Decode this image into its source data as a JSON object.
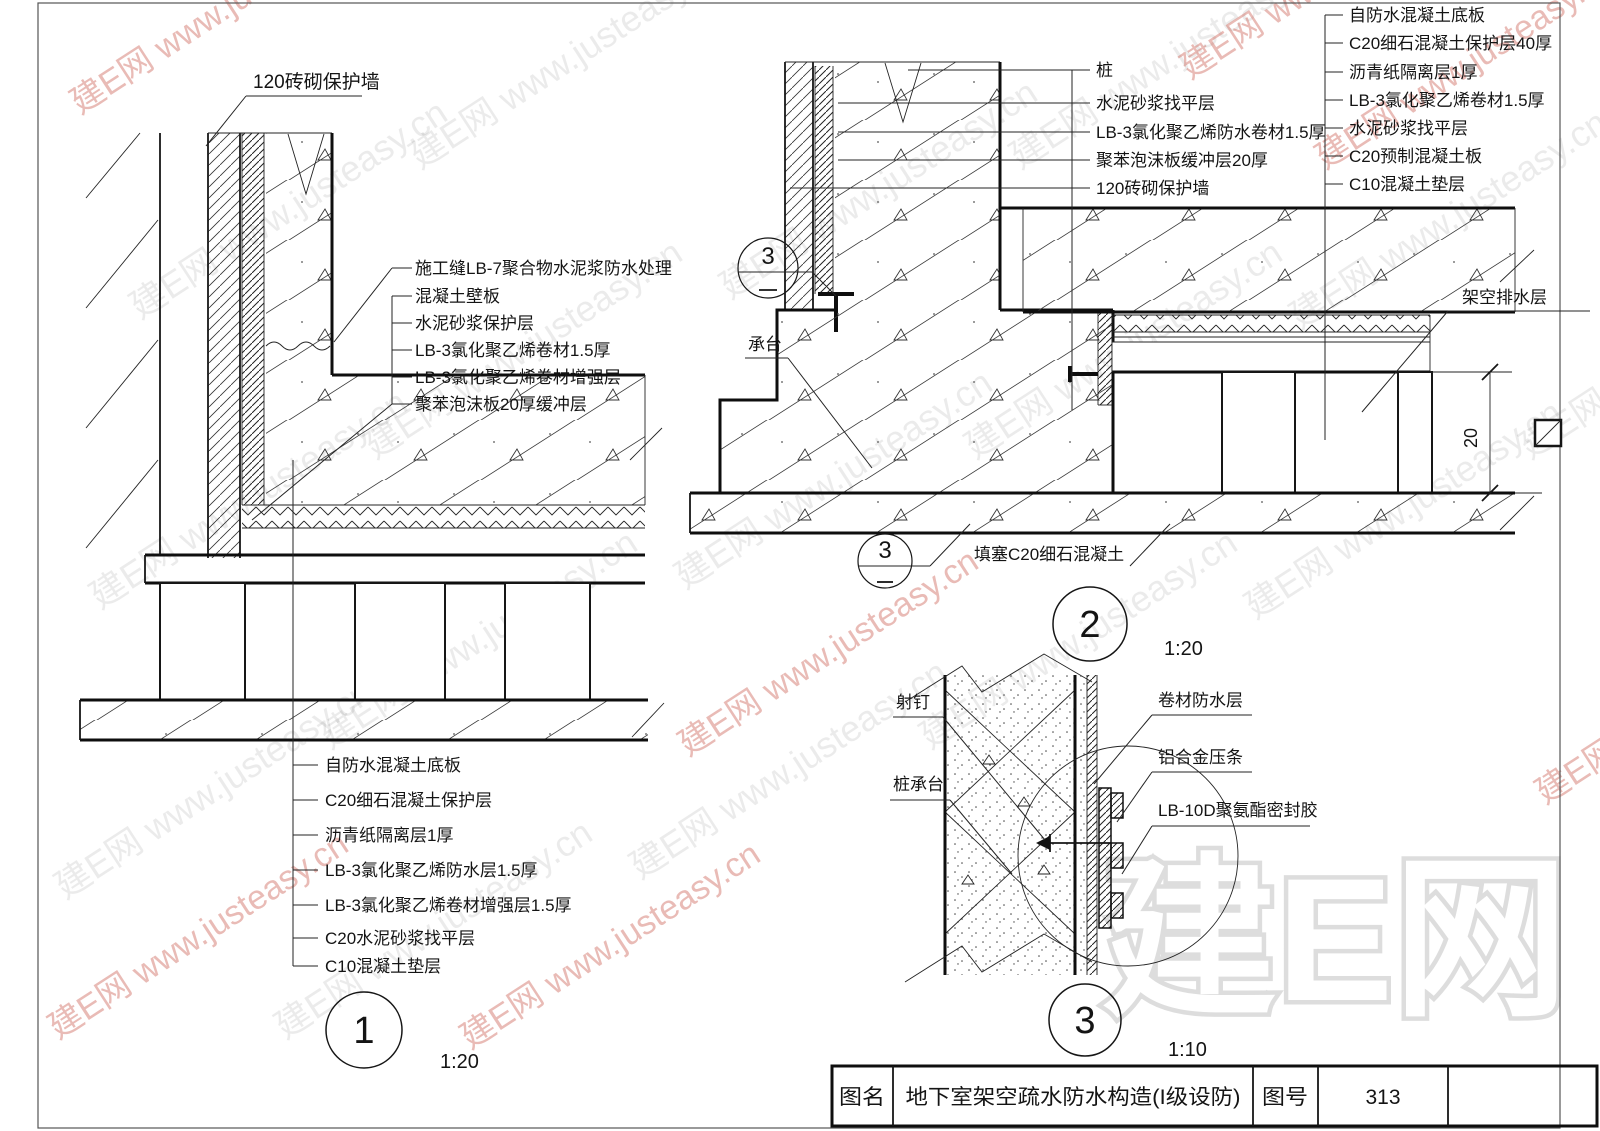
{
  "watermarks": {
    "diag": "建E网 www.justeasy.cn",
    "logo": "建E网"
  },
  "detail1": {
    "number": "1",
    "scale": "1:20",
    "top_label": "120砖砌保护墙",
    "wall_layers": [
      "施工缝LB-7聚合物水泥浆防水处理",
      "混凝土壁板",
      "水泥砂浆保护层",
      "LB-3氯化聚乙烯卷材1.5厚",
      "LB-3氯化聚乙烯卷材增强层",
      "聚苯泡沫板20厚缓冲层"
    ],
    "floor_layers": [
      "自防水混凝土底板",
      "C20细石混凝土保护层",
      "沥青纸隔离层1厚",
      "LB-3氯化聚乙烯防水层1.5厚",
      "LB-3氯化聚乙烯卷材增强层1.5厚",
      "C20水泥砂浆找平层",
      "C10混凝土垫层"
    ]
  },
  "detail2": {
    "number": "2",
    "scale": "1:20",
    "ref_bubble_number": "3",
    "left_labels": [
      "桩",
      "水泥砂浆找平层",
      "LB-3氯化聚乙烯防水卷材1.5厚",
      "聚苯泡沫板缓冲层20厚",
      "120砖砌保护墙"
    ],
    "right_labels": [
      "自防水混凝土底板",
      "C20细石混凝土保护层40厚",
      "沥青纸隔离层1厚",
      "LB-3氯化聚乙烯卷材1.5厚",
      "水泥砂浆找平层",
      "C20预制混凝土板",
      "C10混凝土垫层"
    ],
    "pile_cap_label": "承台",
    "fill_label": "填塞C20细石混凝土",
    "drain_label": "架空排水层",
    "dim_20": "20"
  },
  "detail3": {
    "number": "3",
    "scale": "1:10",
    "nail_label": "射钉",
    "pile_cap_label": "桩承台",
    "membrane_label": "卷材防水层",
    "strip_label": "铝合金压条",
    "sealant_label": "LB-10D聚氨酯密封胶"
  },
  "title_block": {
    "name_label": "图名",
    "name_value": "地下室架空疏水防水构造(I级设防)",
    "number_label": "图号",
    "number_value": "313"
  }
}
